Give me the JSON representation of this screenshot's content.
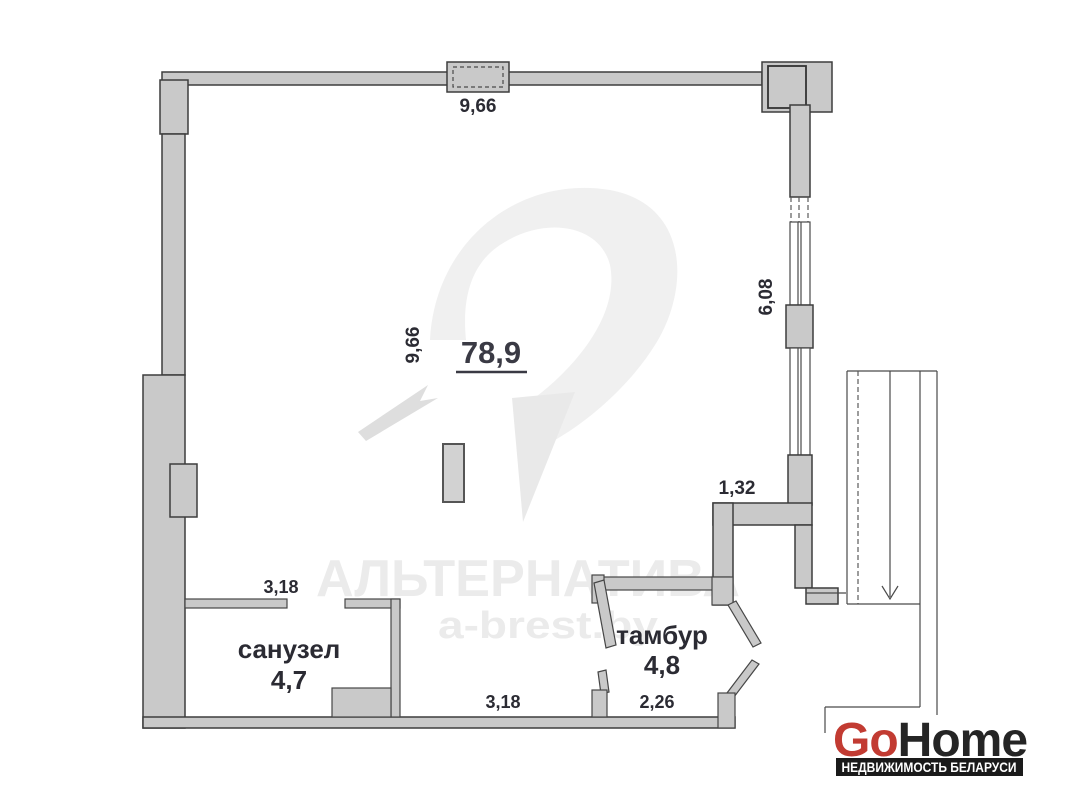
{
  "plan": {
    "total_area": "78,9",
    "rooms": [
      {
        "name": "санузел",
        "area": "4,7"
      },
      {
        "name": "тамбур",
        "area": "4,8"
      }
    ],
    "dimensions": {
      "top_width": "9,66",
      "inner_width": "9,66",
      "right_height": "6,08",
      "niche_width": "1,32",
      "bathroom_width": "3,18",
      "bottom_width": "3,18",
      "tambur_width": "2,26"
    },
    "watermark": {
      "brand": "АЛЬТЕРНАТИВА",
      "site": "a-brest.by",
      "color": "#ebebeb"
    },
    "logo": {
      "go": "Go",
      "home": "Home",
      "tagline": "НЕДВИЖИМОСТЬ БЕЛАРУСИ",
      "go_color": "#c23b32",
      "home_color": "#252525",
      "bar_color": "#1a1a1a"
    },
    "colors": {
      "wall_fill": "#c9c9c9",
      "wall_line": "#3d3d3d",
      "text": "#2b2b33"
    }
  }
}
